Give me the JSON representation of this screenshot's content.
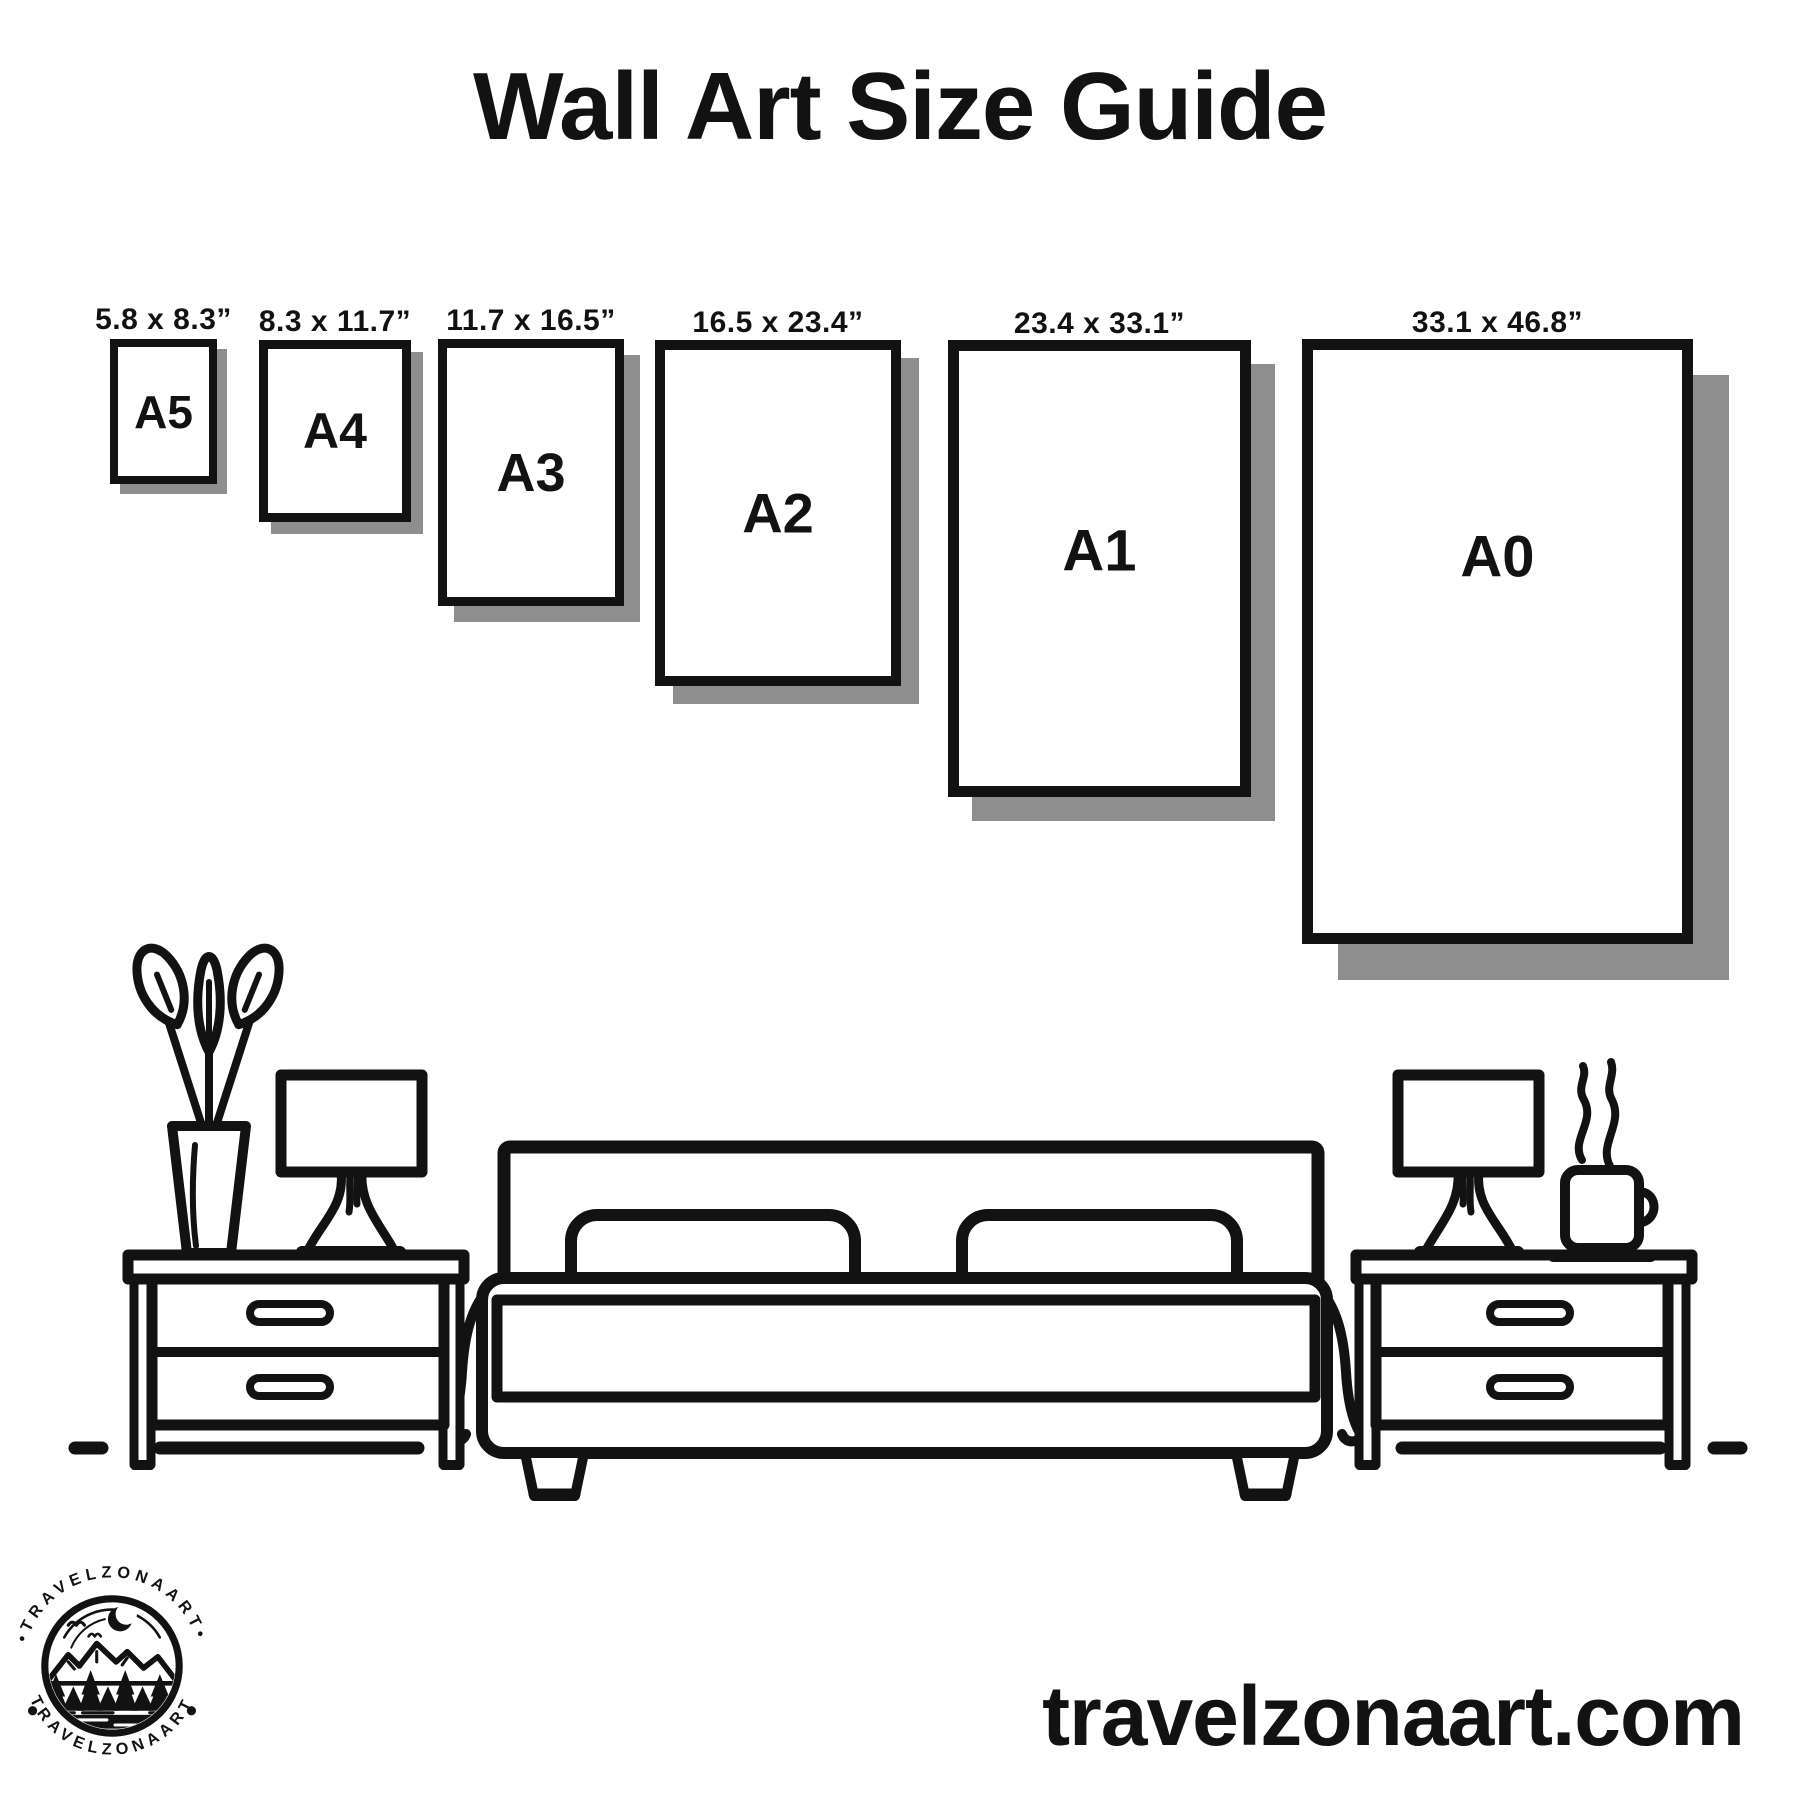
{
  "title": "Wall Art Size Guide",
  "website": "travelzonaart.com",
  "logo": {
    "brand": "TRAVELZONAART",
    "arc_top": "TRAVELZONAART",
    "arc_bottom": "TRAVELZONAART",
    "separator": "•"
  },
  "colors": {
    "ink": "#121212",
    "shadow": "#8e8e8e",
    "background": "#ffffff"
  },
  "sizes": [
    {
      "name": "A5",
      "dimensions": "5.8 x 8.3”",
      "x": 110,
      "y": 339,
      "w": 107,
      "h": 145,
      "border": 8,
      "shadow": 10,
      "label_pos": 0.5,
      "label_size": 46
    },
    {
      "name": "A4",
      "dimensions": "8.3 x 11.7”",
      "x": 259,
      "y": 340,
      "w": 152,
      "h": 182,
      "border": 9,
      "shadow": 12,
      "label_pos": 0.5,
      "label_size": 50
    },
    {
      "name": "A3",
      "dimensions": "11.7 x 16.5”",
      "x": 438,
      "y": 339,
      "w": 186,
      "h": 267,
      "border": 9,
      "shadow": 16,
      "label_pos": 0.5,
      "label_size": 54
    },
    {
      "name": "A2",
      "dimensions": "16.5 x 23.4”",
      "x": 655,
      "y": 340,
      "w": 246,
      "h": 346,
      "border": 10,
      "shadow": 18,
      "label_pos": 0.5,
      "label_size": 56
    },
    {
      "name": "A1",
      "dimensions": "23.4 x 33.1”",
      "x": 948,
      "y": 340,
      "w": 303,
      "h": 457,
      "border": 11,
      "shadow": 24,
      "label_pos": 0.46,
      "label_size": 58
    },
    {
      "name": "A0",
      "dimensions": "33.1 x 46.8”",
      "x": 1302,
      "y": 339,
      "w": 391,
      "h": 605,
      "border": 11,
      "shadow": 36,
      "label_pos": 0.355,
      "label_size": 58
    }
  ],
  "illustration_items": [
    "potted-plant",
    "vase",
    "table-lamp",
    "nightstand",
    "double-bed",
    "pillows",
    "coffee-cup",
    "steam"
  ]
}
